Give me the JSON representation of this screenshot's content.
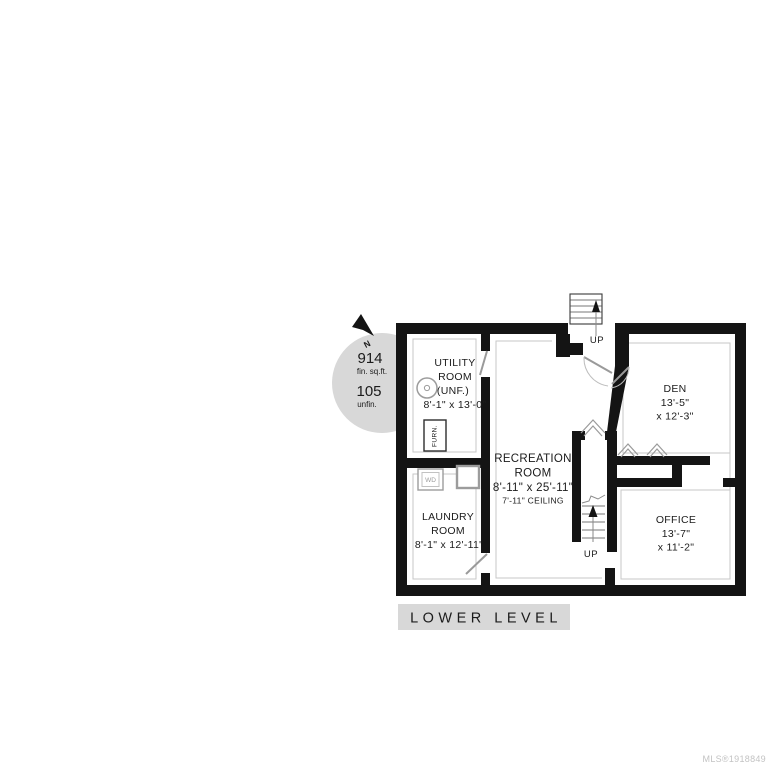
{
  "stats": {
    "north": "N",
    "finished_value": "914",
    "finished_unit": "fin. sq.ft.",
    "unfinished_value": "105",
    "unfinished_unit": "unfin."
  },
  "rooms": {
    "utility": {
      "line1": "UTILITY",
      "line2": "ROOM",
      "line3": "(UNF.)",
      "dims": "8'-1\" x 13'-0\""
    },
    "den": {
      "name": "DEN",
      "dim_w": "13'-5\"",
      "dim_h": "x 12'-3\""
    },
    "recreation": {
      "line1": "RECREATION",
      "line2": "ROOM",
      "dims": "8'-11\" x 25'-11\"",
      "ceiling": "7'-11\" CEILING"
    },
    "laundry": {
      "line1": "LAUNDRY",
      "line2": "ROOM",
      "dims": "8'-1\" x 12'-11\""
    },
    "office": {
      "name": "OFFICE",
      "dim_w": "13'-7\"",
      "dim_h": "x 11'-2\""
    }
  },
  "labels": {
    "up_entry": "UP",
    "up_stairs": "UP",
    "furnace": "FURN.",
    "washer_dryer": "WD"
  },
  "footer": {
    "title": "LOWER LEVEL",
    "mls": "MLS®1918849"
  },
  "colors": {
    "wall": "#141414",
    "inner_outline": "#c7c7c7",
    "stats_circle": "#d8d8d8",
    "title_bar": "#d8d8d8",
    "mls_text": "#c3c3c3",
    "label_text": "#1b1b1b",
    "fixture_gray": "#9c9c9c"
  }
}
